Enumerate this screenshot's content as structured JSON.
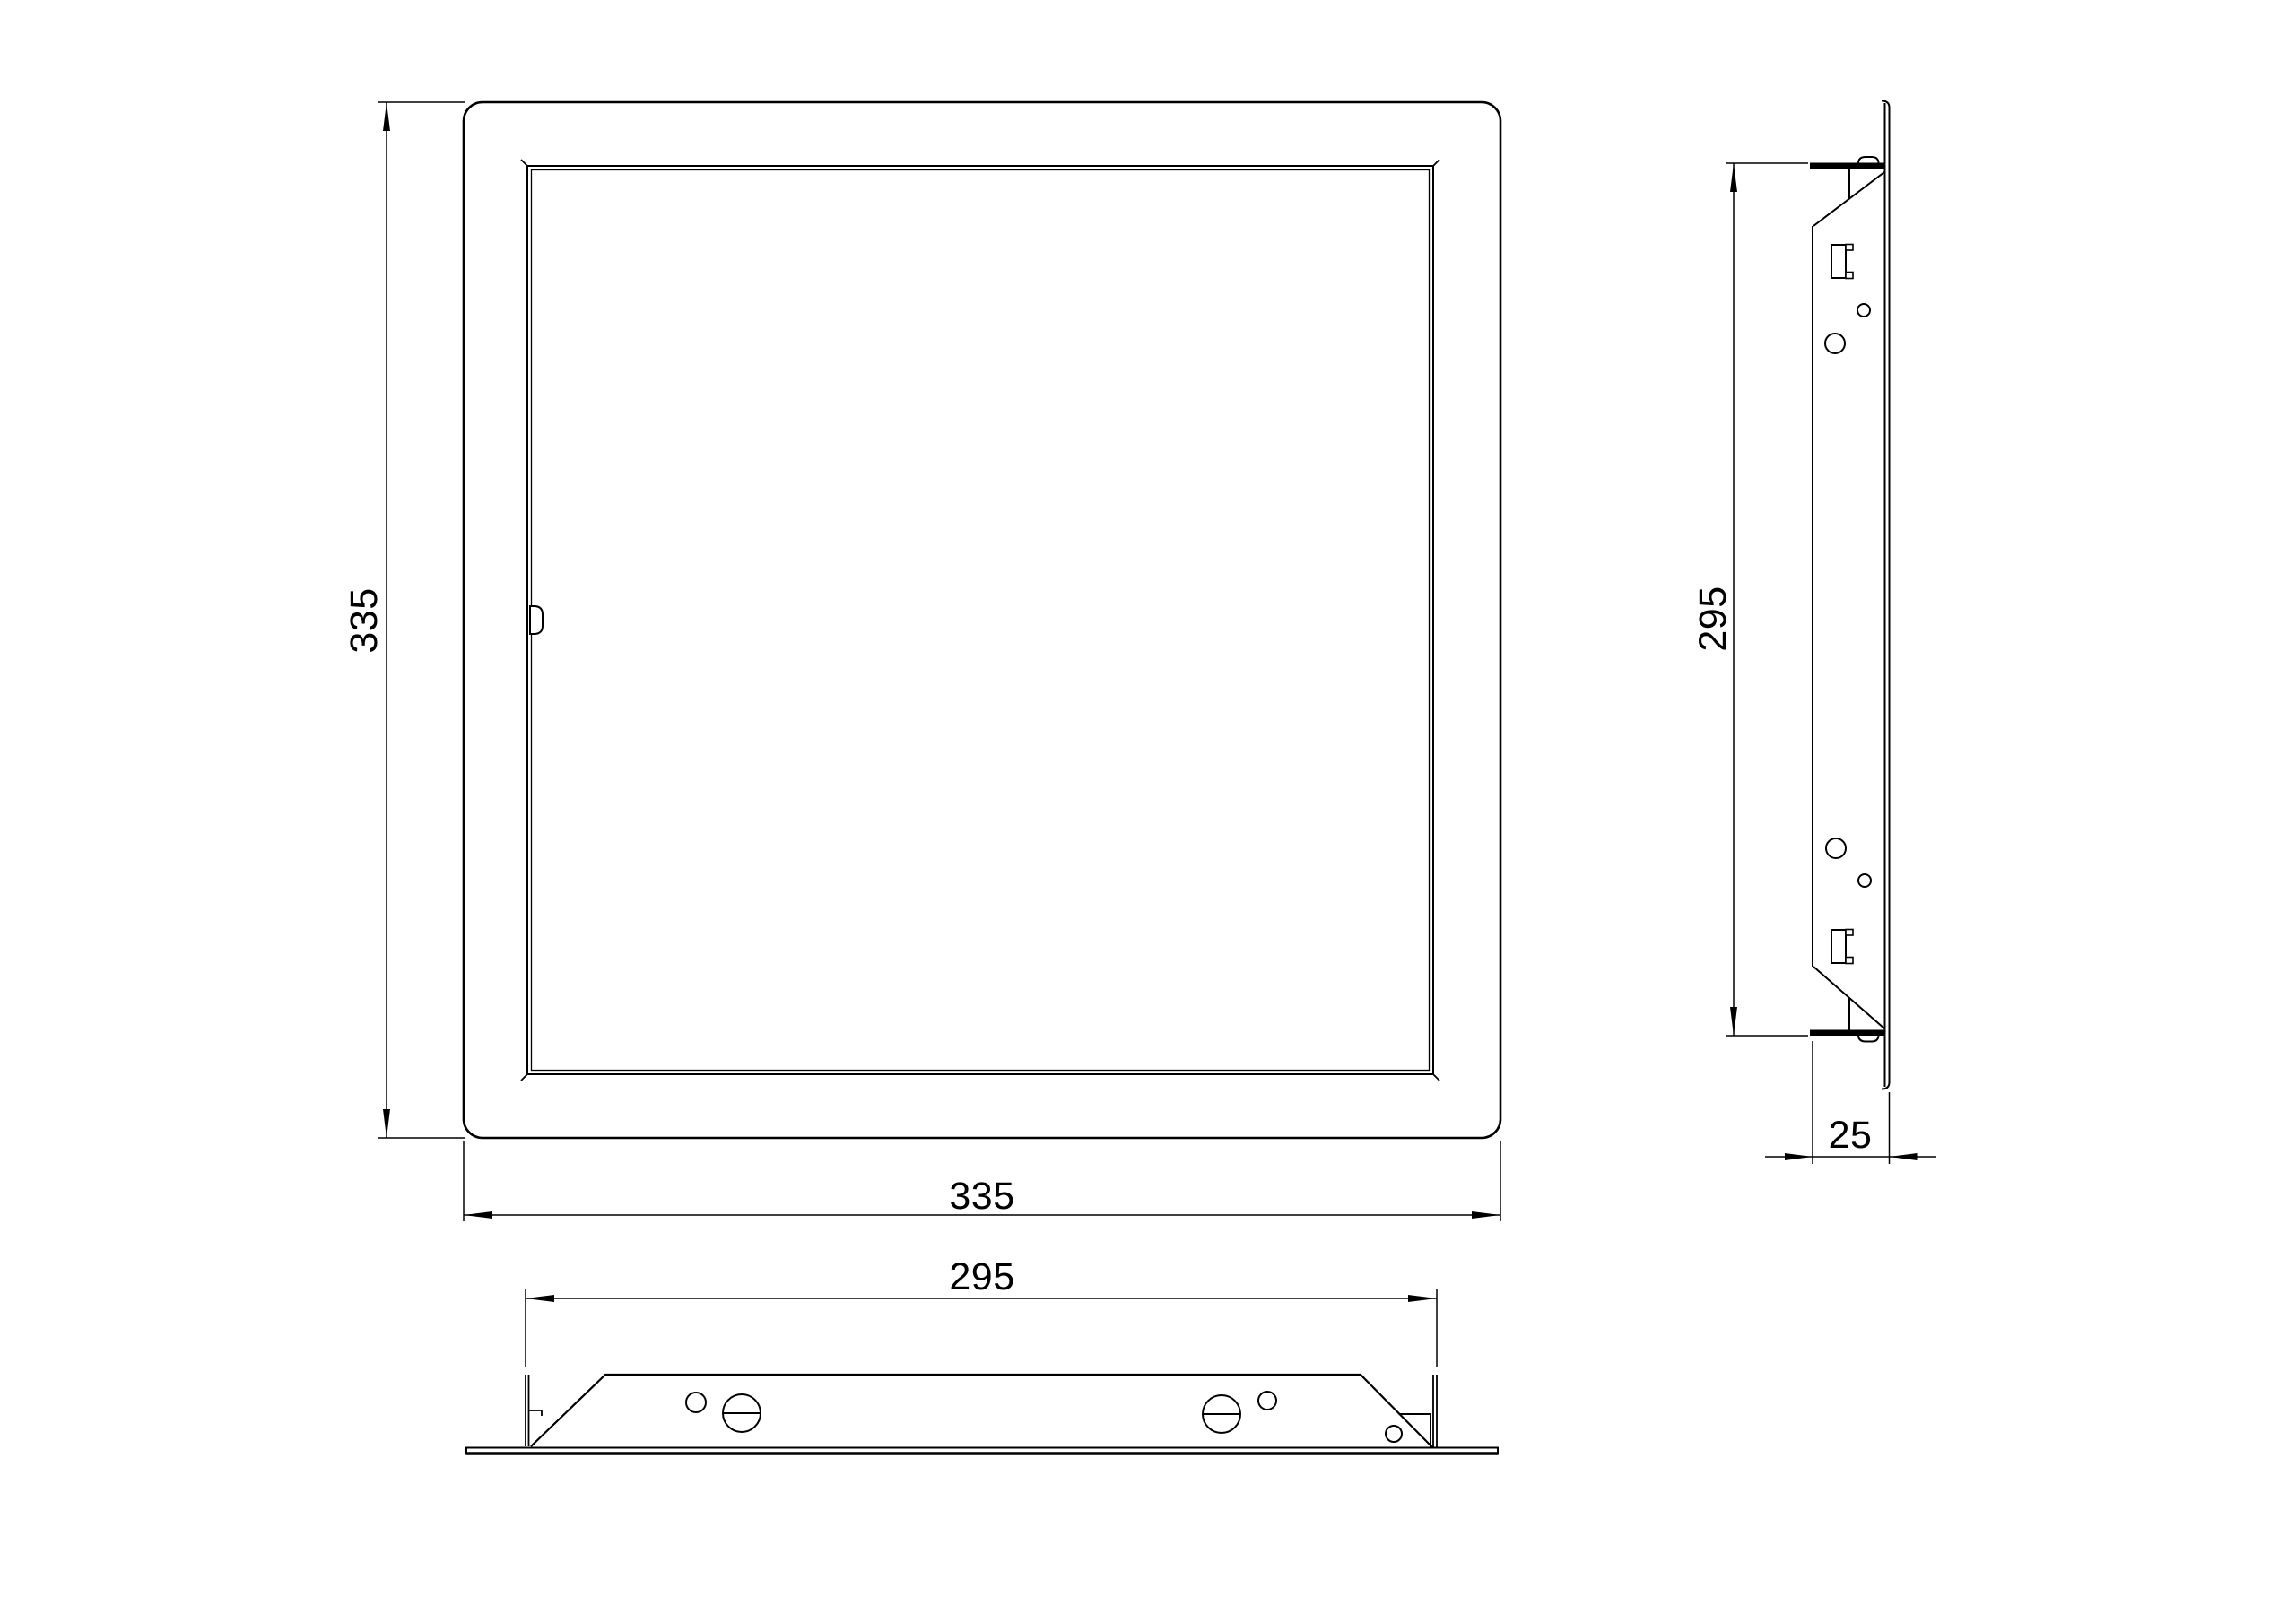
{
  "drawing": {
    "type": "technical-drawing",
    "subject": "access-panel",
    "colors": {
      "line": "#000000",
      "background": "#ffffff"
    },
    "views": {
      "front_view": {
        "dims": {
          "height": {
            "label": "335",
            "orientation": "vertical"
          },
          "width": {
            "label": "335",
            "orientation": "horizontal"
          }
        }
      },
      "side_view": {
        "dims": {
          "height": {
            "label": "295",
            "orientation": "vertical"
          },
          "depth": {
            "label": "25",
            "orientation": "horizontal"
          }
        }
      },
      "bottom_view": {
        "dims": {
          "width": {
            "label": "295",
            "orientation": "horizontal"
          }
        }
      }
    }
  }
}
